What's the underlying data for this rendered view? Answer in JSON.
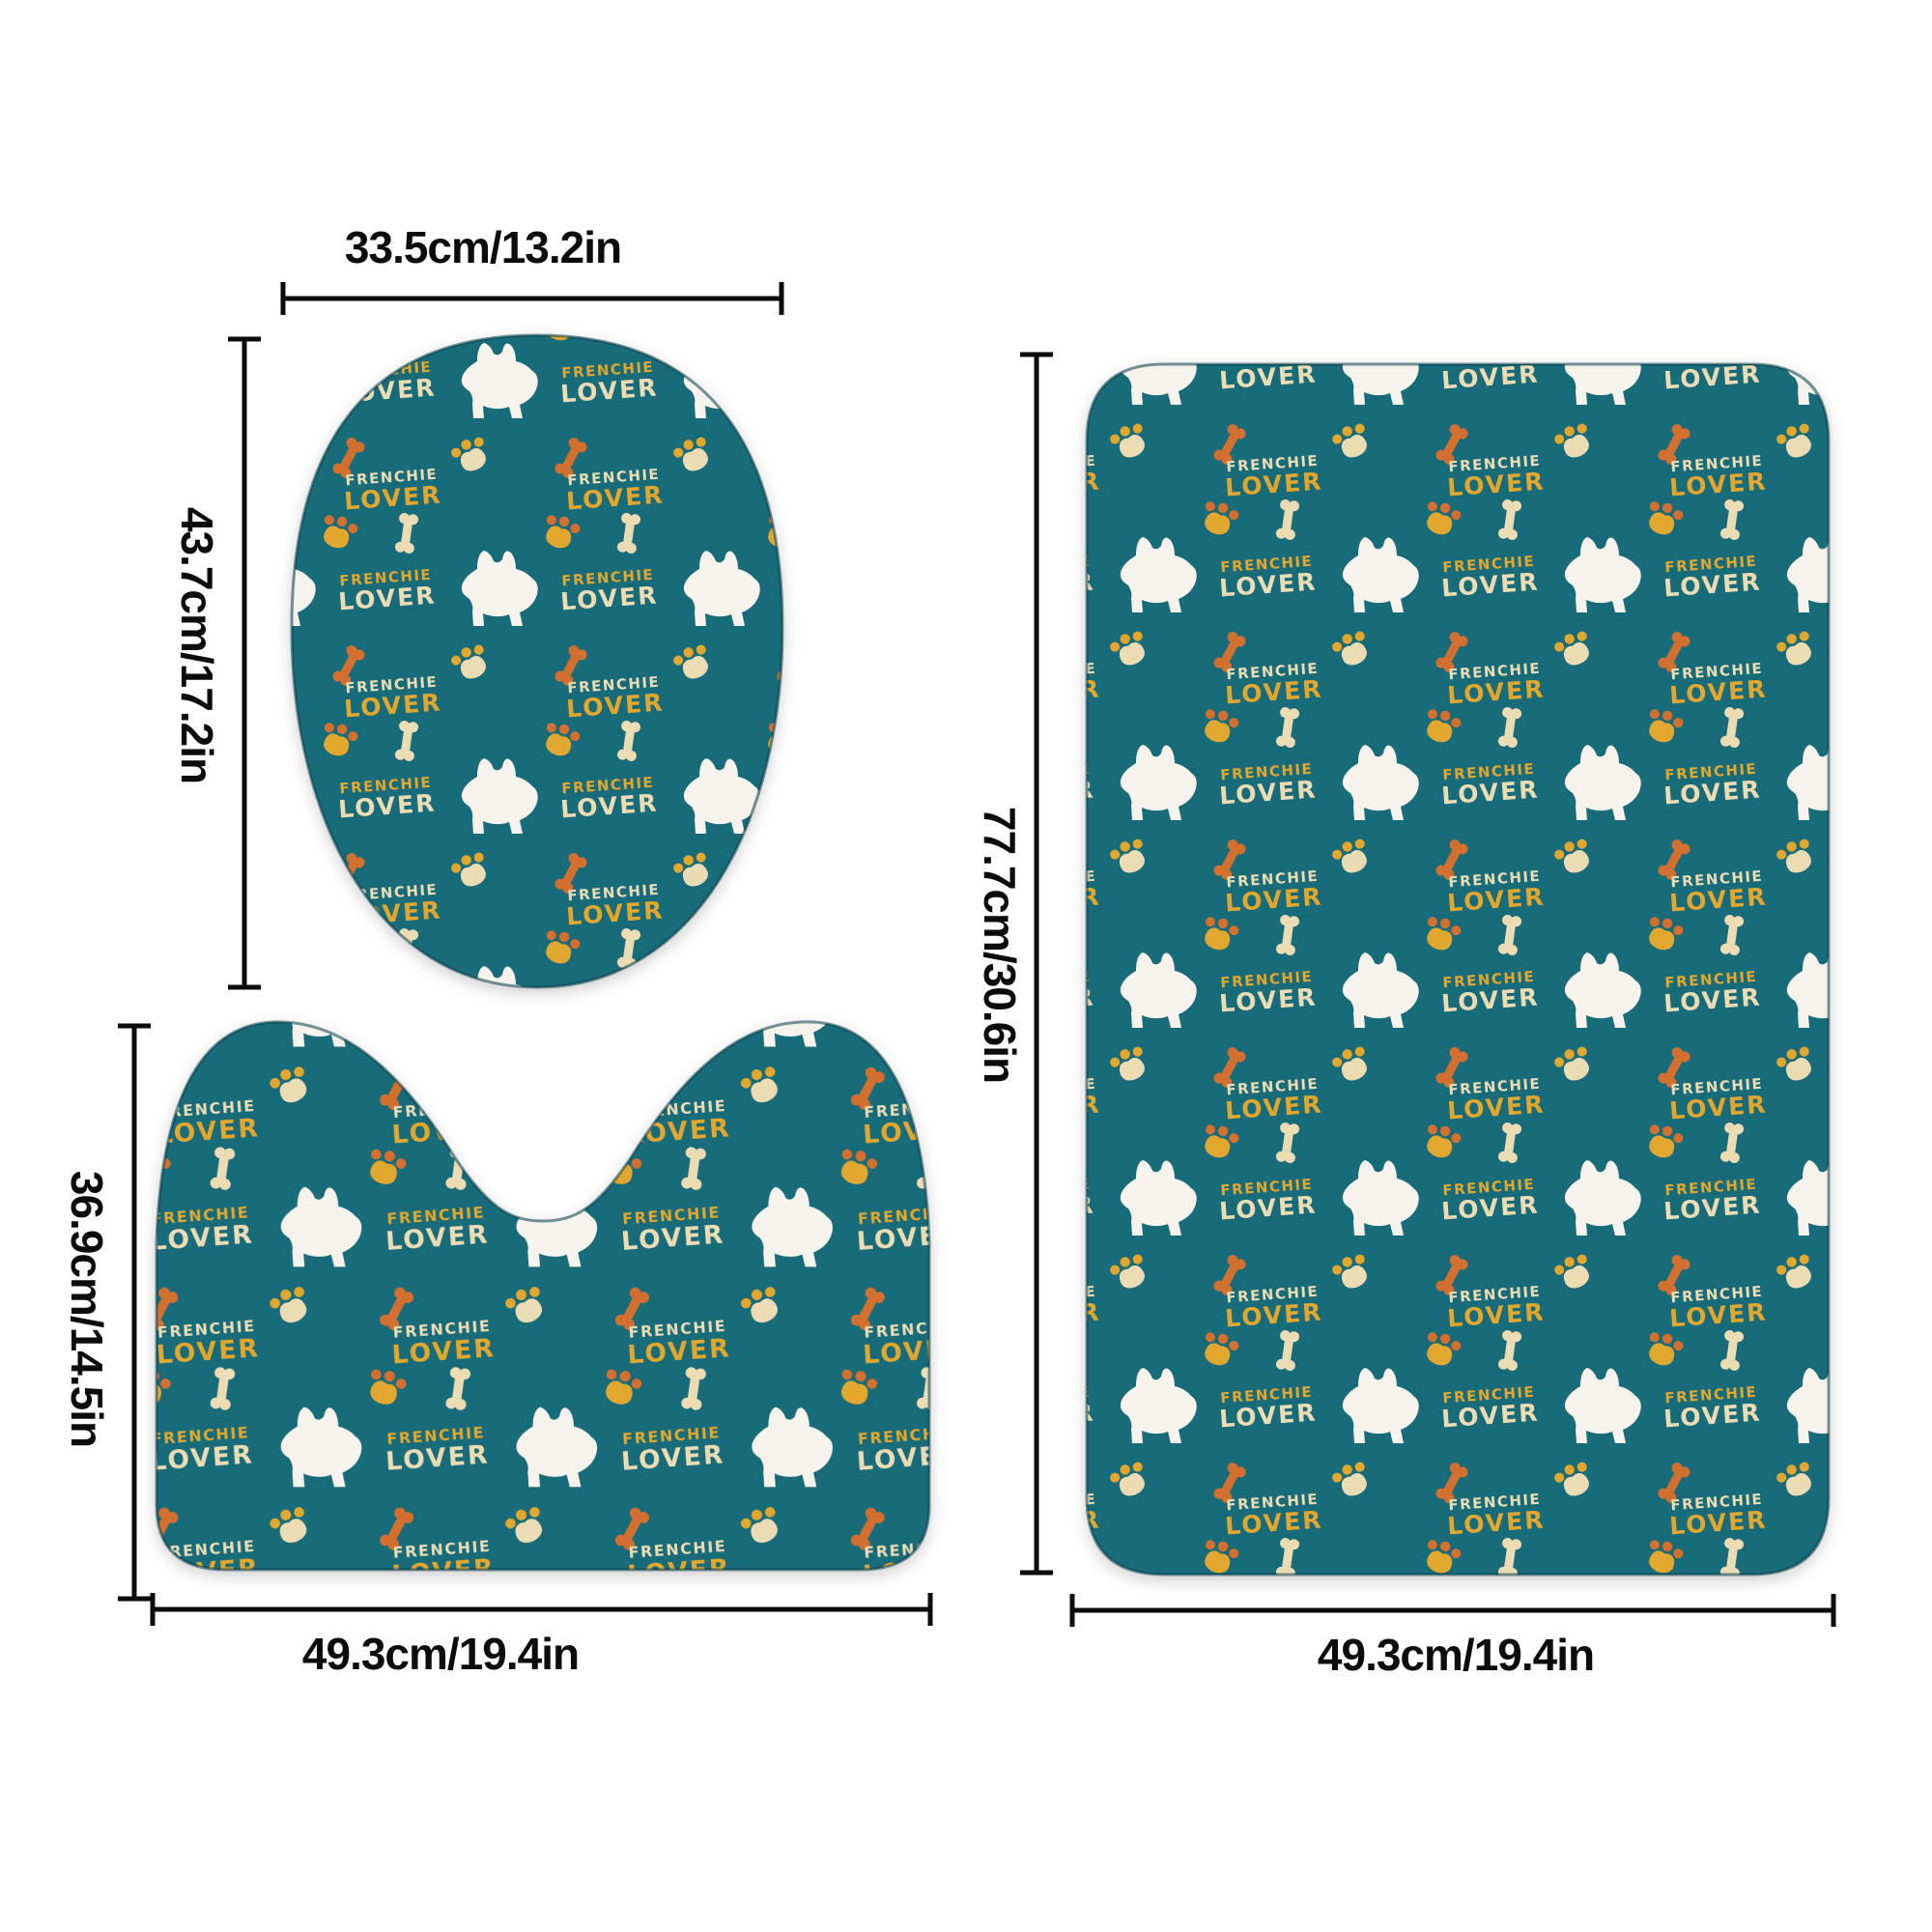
{
  "pieces": {
    "lid": {
      "name": "toilet-lid-cover",
      "width_label": "33.5cm/13.2in",
      "height_label": "43.7cm/17.2in"
    },
    "contour": {
      "name": "contour-mat",
      "width_label": "49.3cm/19.4in",
      "height_label": "36.9cm/14.5in"
    },
    "mat": {
      "name": "bath-mat",
      "width_label": "49.3cm/19.4in",
      "height_label": "77.7cm/30.6in"
    }
  },
  "pattern": {
    "frenchie": "FRENCHIE",
    "lover": "LOVER",
    "motifs": [
      "french-bulldog-silhouette",
      "dog-bone",
      "paw-print"
    ],
    "colors": {
      "teal": "#186B79",
      "white": "#F5F3EB",
      "cream": "#EBDCB4",
      "yellow": "#E2A72E",
      "orange": "#D4702F",
      "dimension": "#0c0c0c"
    }
  }
}
